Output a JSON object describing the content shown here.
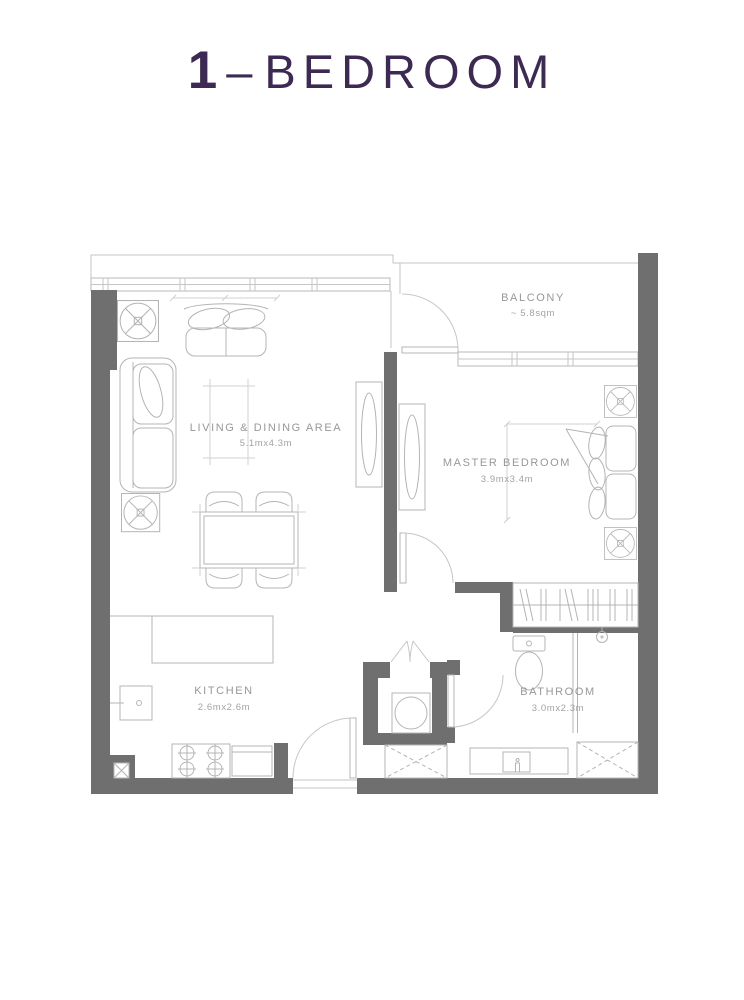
{
  "title": {
    "number": "1",
    "separator": "–",
    "label": "BEDROOM"
  },
  "rooms": {
    "balcony": {
      "name": "BALCONY",
      "area": "~ 5.8sqm"
    },
    "living": {
      "name": "LIVING & DINING AREA",
      "dims": "5.1mx4.3m"
    },
    "master": {
      "name": "MASTER BEDROOM",
      "dims": "3.9mx3.4m"
    },
    "kitchen": {
      "name": "KITCHEN",
      "dims": "2.6mx2.6m"
    },
    "bathroom": {
      "name": "BATHROOM",
      "dims": "3.0mx2.3m"
    }
  },
  "colors": {
    "title_purple": "#3d2a54",
    "wall_gray": "#6f6f6f",
    "line_gray": "#c6c6c6",
    "furniture_gray": "#b4b4b4",
    "label_gray": "#989898"
  }
}
